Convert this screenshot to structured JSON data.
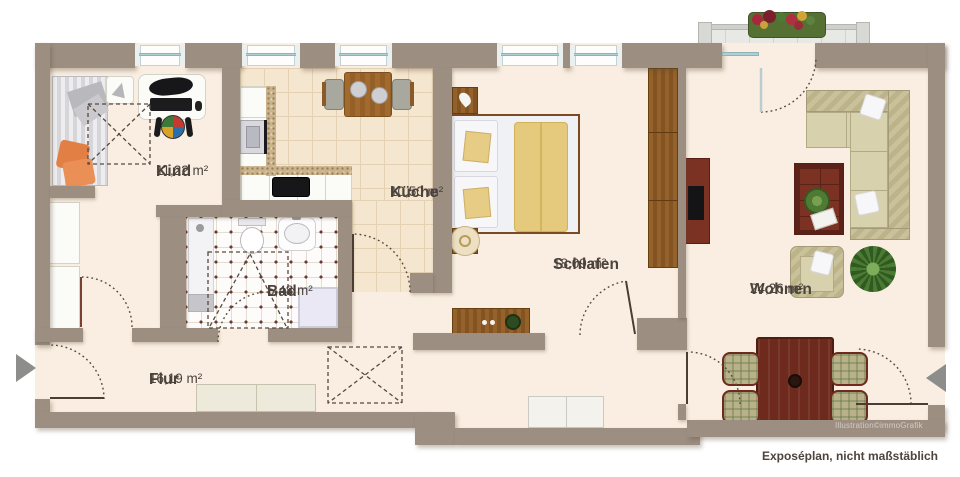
{
  "plan": {
    "rooms": [
      {
        "name": "Kind",
        "area": "11,22 m²"
      },
      {
        "name": "Küche",
        "area": "10,50 m²"
      },
      {
        "name": "Bad",
        "area": "5,48 m²"
      },
      {
        "name": "Flur",
        "area": "16,19 m²"
      },
      {
        "name": "Schlafen",
        "area": "18,09 m²"
      },
      {
        "name": "Wohnen",
        "area": "24,26 m²"
      }
    ],
    "watermark": "Illustration©immoGrafik",
    "caption": "Exposéplan, nicht maßstäblich",
    "colors": {
      "wall": "#9c8e81",
      "floor": "#f9eee1",
      "kitchen_tile": "#f5e6cf",
      "bath_dot": "#6e392f",
      "label_text": "#4b433c",
      "wood": "#8a5828",
      "red_wood": "#7b3223",
      "window_glass": "#aecfd3"
    }
  }
}
